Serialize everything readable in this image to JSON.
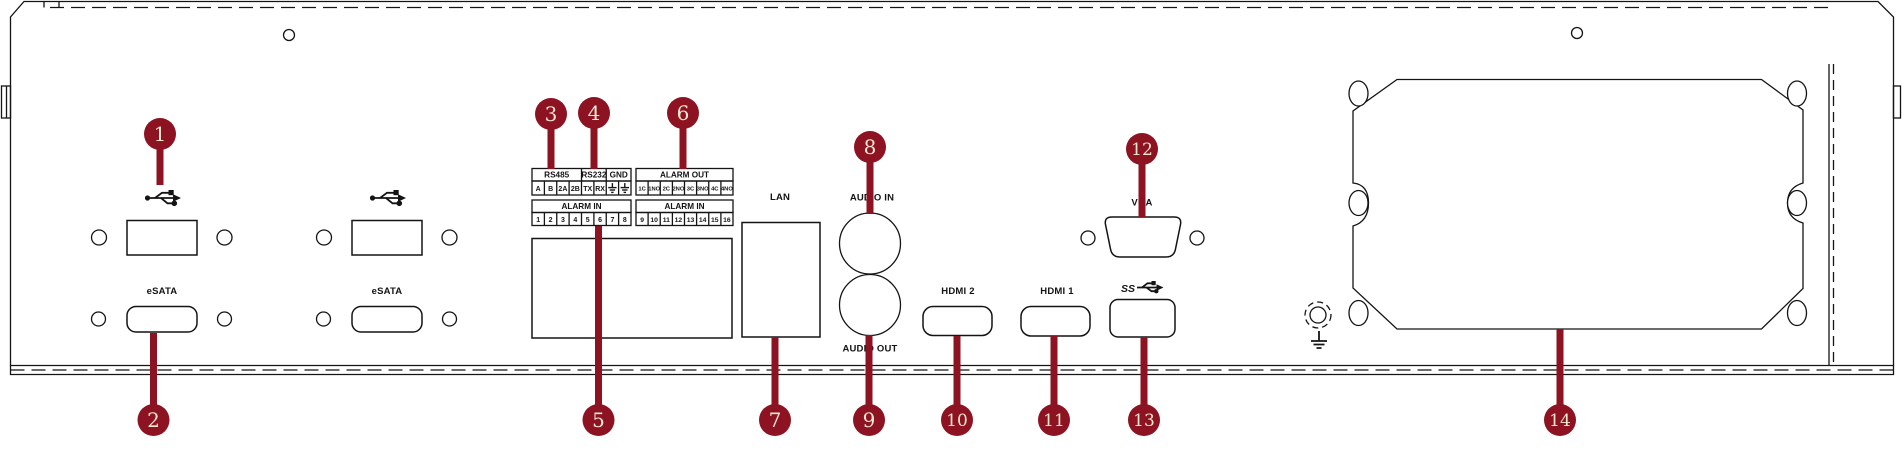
{
  "colors": {
    "accent": "#8D1322",
    "ink": "#141414",
    "numeral": "#F2E8CE",
    "background": "#FFFFFF"
  },
  "ports": {
    "usb_groups": [
      {
        "usb_icon": "usb-icon",
        "esata_label": "eSATA"
      },
      {
        "usb_icon": "usb-icon",
        "esata_label": "eSATA"
      }
    ],
    "serial_block": {
      "rs485_label": "RS485",
      "rs232_label": "RS232",
      "gnd_label": "GND",
      "pins": [
        "A",
        "B",
        "2A",
        "2B",
        "TX",
        "RX"
      ],
      "gnd_pin_icon": "earth-ground-icon"
    },
    "alarm_in_left": {
      "header": "ALARM IN",
      "pins": [
        "1",
        "2",
        "3",
        "4",
        "5",
        "6",
        "7",
        "8"
      ]
    },
    "alarm_out": {
      "header": "ALARM OUT",
      "pins": [
        "1C",
        "1NO",
        "2C",
        "2NO",
        "3C",
        "3NO",
        "4C",
        "4NO"
      ]
    },
    "alarm_in_right": {
      "header": "ALARM IN",
      "pins": [
        "9",
        "10",
        "11",
        "12",
        "13",
        "14",
        "15",
        "16"
      ]
    },
    "lan_label": "LAN",
    "audio_in_label": "AUDIO IN",
    "audio_out_label": "AUDIO OUT",
    "hdmi2_label": "HDMI 2",
    "hdmi1_label": "HDMI 1",
    "vga_label": "VGA",
    "usb3_ss_label": "SS",
    "ground_icon": "earth-ground-icon"
  },
  "callouts": [
    "1",
    "2",
    "3",
    "4",
    "5",
    "6",
    "7",
    "8",
    "9",
    "10",
    "11",
    "12",
    "13",
    "14"
  ]
}
